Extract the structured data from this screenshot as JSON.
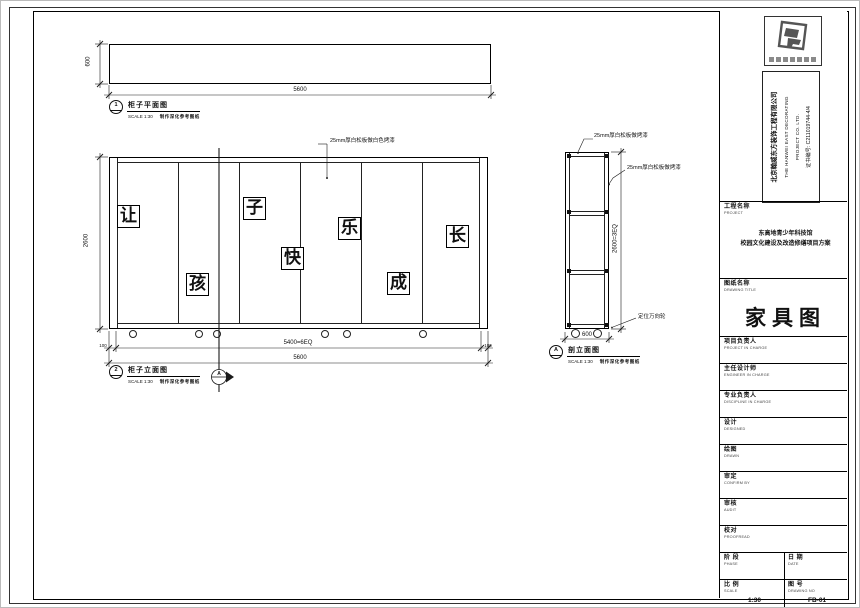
{
  "company": {
    "name_cn": "北京翰威东方装饰工程有限公司",
    "name_en_1": "THE HANWEI EAST DECORATING",
    "name_en_2": "PROJECT CO. LTD.",
    "certificate": "证书编号: C211019744-4/4"
  },
  "project": {
    "label_cn": "工程名称",
    "label_en": "PROJECT",
    "name_line1": "东高地青少年科技馆",
    "name_line2": "校园文化建设及改造修缮项目方案"
  },
  "drawing": {
    "label_cn": "图纸名称",
    "label_en": "DRAWING TITLE",
    "title": "家具图"
  },
  "signature_rows": [
    {
      "cn": "项目负责人",
      "en": "PROJECT IN CHARGE"
    },
    {
      "cn": "主任设计师",
      "en": "ENGINEER IN CHARGE"
    },
    {
      "cn": "专业负责人",
      "en": "DISCIPLINE IN CHARGE"
    },
    {
      "cn": "设计",
      "en": "DESIGNED"
    },
    {
      "cn": "绘图",
      "en": "DRAWN"
    },
    {
      "cn": "审定",
      "en": "CONFIRM BY"
    },
    {
      "cn": "审核",
      "en": "AUDIT"
    },
    {
      "cn": "校对",
      "en": "PROOFREAD"
    }
  ],
  "footer": {
    "phase_cn": "阶 段",
    "phase_en": "PHASE",
    "date_cn": "日 期",
    "date_en": "DATE",
    "scale_cn": "比 例",
    "scale_en": "SCALE",
    "scale_value": "1:30",
    "no_cn": "图 号",
    "no_en": "DRAWING NO",
    "no_value": "FB-01"
  },
  "views": {
    "plan": {
      "tag": "1",
      "title": "柜子平面图",
      "scale": "SCALE 1:30",
      "note": "制作深化参考图纸",
      "dim_height": "600",
      "dim_width": "5600"
    },
    "elevation": {
      "tag": "2",
      "title": "柜子立面图",
      "scale": "SCALE 1:30",
      "note": "制作深化参考图纸",
      "chars": [
        "让",
        "孩",
        "子",
        "快",
        "乐",
        "成",
        "长"
      ],
      "leader": "25mm厚白松板做白色烤漆",
      "dim_height": "2600",
      "dim_left": "100",
      "dim_mid": "5400=6EQ",
      "dim_right": "100",
      "dim_total": "5600",
      "section_tag": "A"
    },
    "side": {
      "tag": "A",
      "title": "剖立面图",
      "scale": "SCALE 1:30",
      "note": "制作深化参考图纸",
      "leader_top": "25mm厚白松板做烤漆",
      "leader_side": "25mm厚白松板做烤漆",
      "leader_wheel": "定位万向轮",
      "dim_height": "2600=3EQ",
      "dim_width": "600"
    }
  }
}
